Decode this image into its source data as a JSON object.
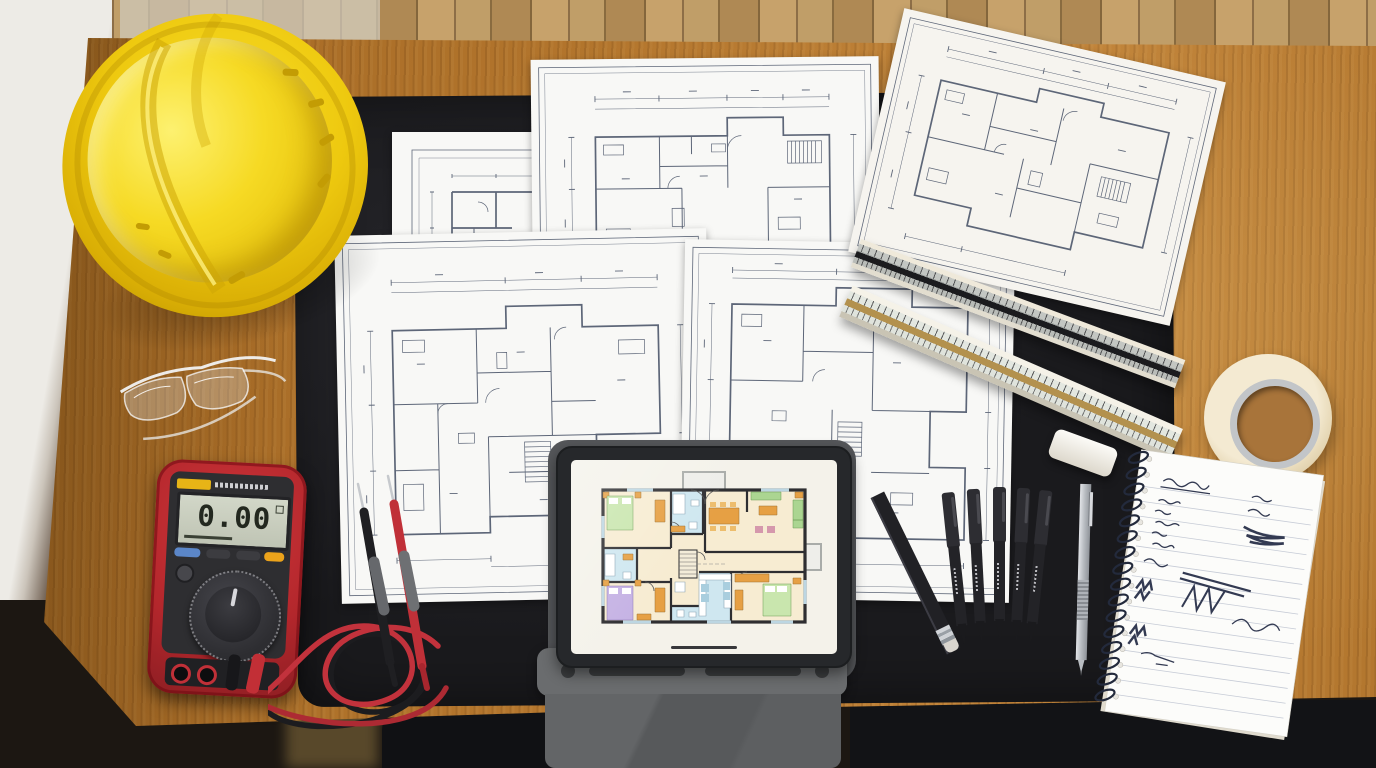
{
  "scene": {
    "description": "Top-down photo of an architect's oak desk: yellow hard hat, safety glasses, red digital multimeter with test leads, printed blueprint floor plans, two triangular scale rulers, eraser, masking tape roll, black fineliner pens, pencils, spiral notebook with handwritten notes, and a tablet in a gray folio case displaying a colored floor plan on a black desk mat",
    "multimeter": {
      "display_value": "0.00",
      "body_color": "#b3282e",
      "face_color": "#2e2e31",
      "lcd_color": "#c9cfc0",
      "brand_badge_color": "#e7b416",
      "button_colors": [
        "#5b86c8",
        "#3c3c40",
        "#3c3c40",
        "#eca31b"
      ],
      "lead_colors": [
        "#c2323c",
        "#1f1f22"
      ]
    },
    "hard_hat": {
      "color": "#f0cd10"
    },
    "safety_glasses": {
      "style": "clear transparent"
    },
    "desk": {
      "wood_color": "#b5772e"
    },
    "desk_mat": {
      "color": "#1a1a1d"
    },
    "tablet": {
      "bezel_color": "#26282b",
      "case_color": "#66686a",
      "screen_color": "#f4f2ea",
      "floorplan_palette": {
        "room": "#f7ecd2",
        "wet_room": "#cfe7f0",
        "furniture_wood": "#e6a044",
        "bed_green": "#c9e6ae",
        "bed_purple": "#c5b2e4",
        "sofa_green": "#abd591",
        "chair_pink": "#d598ac",
        "wall": "#2e2e31"
      }
    },
    "blueprints": {
      "sheet_count": 5,
      "ink_color": "#5d6678",
      "paper_color": "#f8f8f6"
    },
    "scale_rulers": [
      {
        "body_color": "#c3c6c2",
        "stripe_color": "#1b1b1e"
      },
      {
        "body_color": "#e3e7e0",
        "stripe_color": "#b3914e"
      }
    ],
    "masking_tape": {
      "color": "#ecdfc4"
    },
    "eraser": {
      "color": "#f0efe9"
    },
    "pens": {
      "count": 5,
      "color": "#232327"
    },
    "mechanical_pencil": {
      "color": "#b9bdc2"
    },
    "pencil": {
      "color": "#212125"
    },
    "notebook": {
      "paper_color": "#fbfbf8",
      "ink_color": "#333a52",
      "binding": "spiral"
    }
  }
}
